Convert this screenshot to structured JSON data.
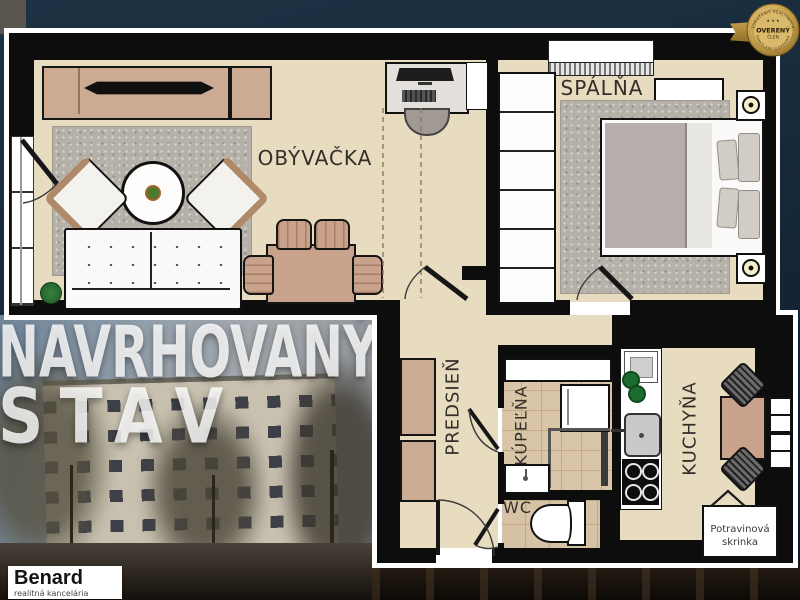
{
  "floorplan": {
    "rooms": [
      {
        "id": "living-room",
        "label": "OBÝVAČKA"
      },
      {
        "id": "bedroom",
        "label": "SPÁLŇA"
      },
      {
        "id": "hallway",
        "label": "PREDSIEŇ"
      },
      {
        "id": "bathroom",
        "label": "KÚPEĽŇA"
      },
      {
        "id": "wc",
        "label": "WC"
      },
      {
        "id": "kitchen",
        "label": "KUCHYŇA"
      }
    ],
    "pantry_label": "Potravinová skrinka"
  },
  "photo": {
    "overlay_line1": "NAVRHOVANÝ",
    "overlay_line2": "STAV"
  },
  "agency": {
    "name": "Benard",
    "tagline": "realitná kancelária"
  },
  "badge": {
    "stars": "★ ★ ★",
    "arc_top": "ZDRUŽENIE REALITNÝCH",
    "title": "OVERENÝ",
    "subtitle": "ČLEN",
    "arc_bottom": "KANCELÁRIÍ SLOVENSKA"
  },
  "colors": {
    "wall": "#0d0d0d",
    "floor_beige": "#e7dbc0",
    "bath_tile": "#d9c5a7",
    "furniture_tan": "#c9a28c",
    "badge_gold": "#c49d49",
    "background_navy": "#16293a"
  }
}
